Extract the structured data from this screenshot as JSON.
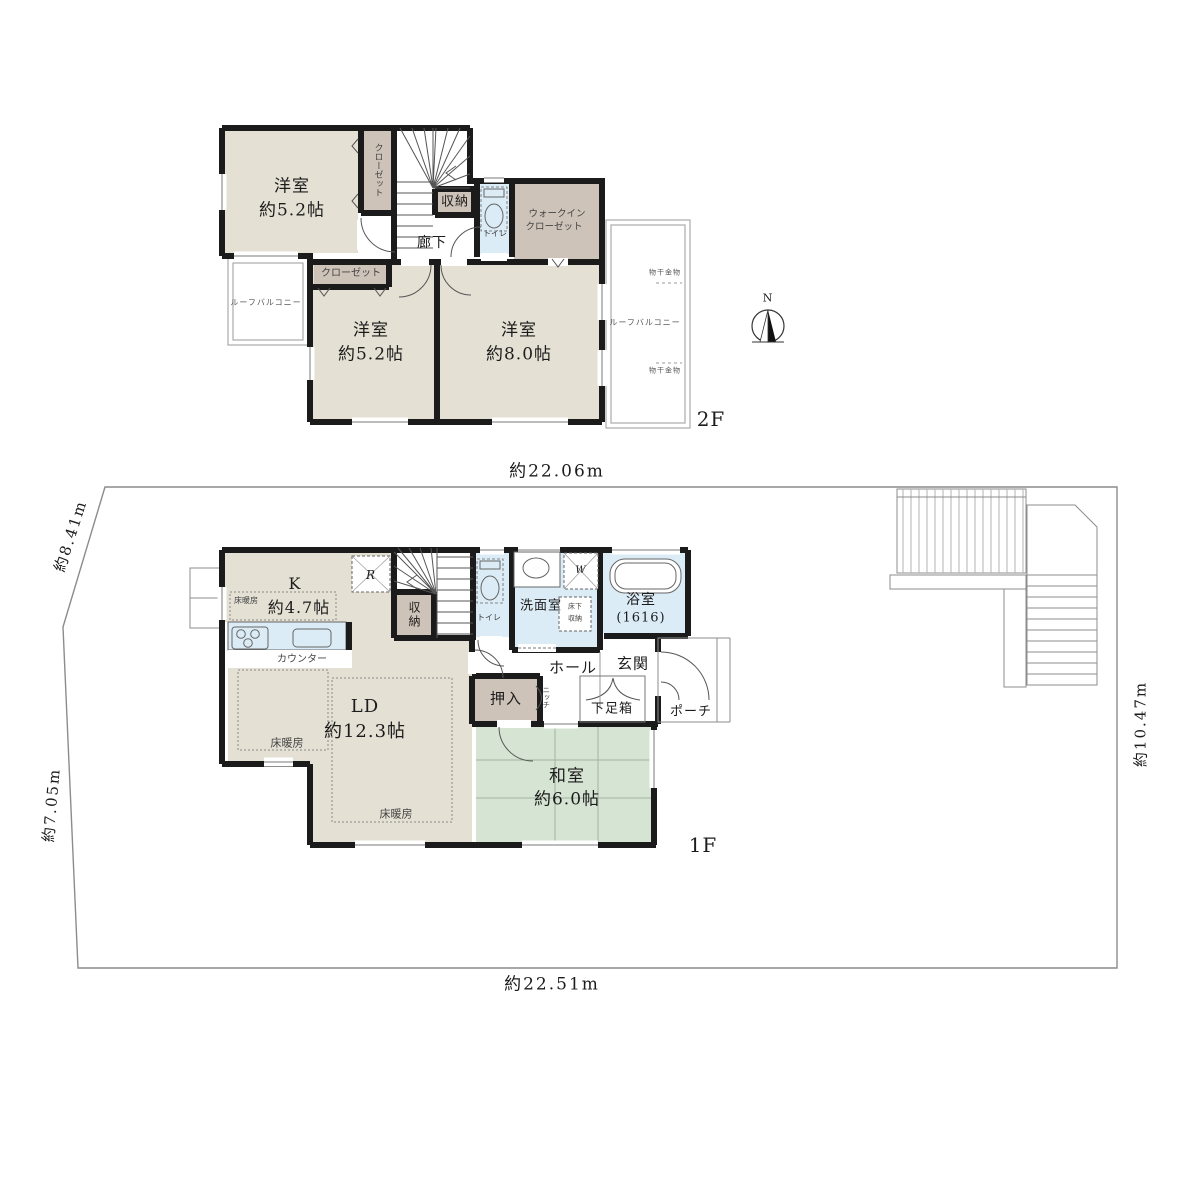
{
  "site": {
    "dim_top": "約22.06m",
    "dim_bottom": "約22.51m",
    "dim_left_upper": "約8.41m",
    "dim_left_lower": "約7.05m",
    "dim_right": "約10.47m",
    "compass_north": "N"
  },
  "floor2": {
    "label": "2F",
    "room_west_name": "洋室",
    "room_west_size": "約5.2帖",
    "room_south_name": "洋室",
    "room_south_size": "約5.2帖",
    "room_east_name": "洋室",
    "room_east_size": "約8.0帖",
    "closet_west": "クローゼット",
    "closet_south": "クローゼット",
    "storage": "収納",
    "hallway": "廊下",
    "toilet": "トイレ",
    "wic_line1": "ウォークイン",
    "wic_line2": "クローゼット",
    "balcony_west": "ルーフバルコニー",
    "balcony_east": "ルーフバルコニー",
    "drying_top": "物干金物",
    "drying_bottom": "物干金物"
  },
  "floor1": {
    "label": "1F",
    "kitchen_name": "K",
    "kitchen_size": "約4.7帖",
    "ld_name": "LD",
    "ld_size": "約12.3帖",
    "washitsu_name": "和室",
    "washitsu_size": "約6.0帖",
    "bath_name": "浴室",
    "bath_size": "(1616)",
    "washroom": "洗面室",
    "toilet": "トイレ",
    "storage": "収納",
    "oshiire": "押入",
    "niche": "ニッチ",
    "hall": "ホール",
    "entrance": "玄関",
    "shoe_box": "下足箱",
    "porch": "ポーチ",
    "counter": "カウンター",
    "floor_heating_kitchen": "床暖房",
    "floor_heating_ld_west": "床暖房",
    "floor_heating_ld_east": "床暖房",
    "underfloor_line1": "床下",
    "underfloor_line2": "収納",
    "refrigerator": "R",
    "washer": "W"
  },
  "colors": {
    "room_beige": "#e5e0d4",
    "closet_brown": "#cec3b9",
    "wet_blue": "#dbecf6",
    "tatami_green": "#d6e5d3",
    "wall_black": "#1b1b1b"
  }
}
